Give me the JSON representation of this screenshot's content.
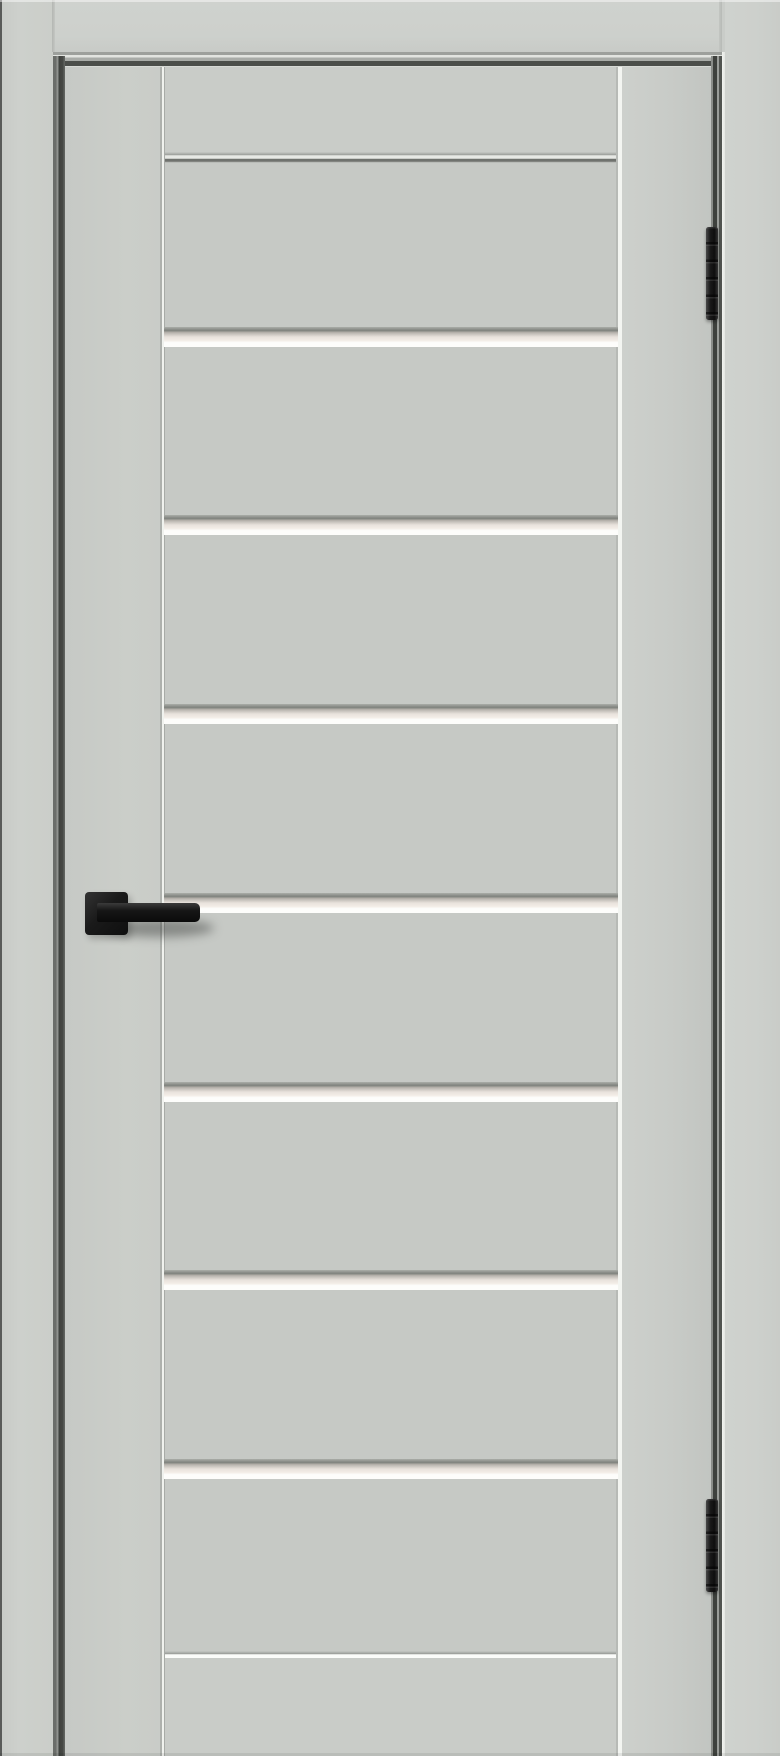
{
  "scene": {
    "type": "product-photo",
    "subject": "light grey interior door in a matching frame, with seven horizontal frosted-glass stripes across the centre panel, a matte black square-rose lever handle on the left stile and two dark concealed hinges in the right-hand gap"
  },
  "colors": {
    "frame": "#cdd0cc",
    "leaf": "#c9ccc8",
    "panel": "#c6c9c5",
    "glass": "#f3ede7",
    "glassbright": "#fdfdfb",
    "gapdark": "#3e413d",
    "hardware": "#1a1a1a"
  },
  "door": {
    "glass_stripes": {
      "count": 7,
      "top_positions_px": [
        327,
        515,
        704,
        893,
        1082,
        1270,
        1459
      ]
    },
    "hinges": {
      "count": 2,
      "top_positions_px": [
        227,
        1499
      ]
    },
    "handle": {
      "style": "square-rose straight lever",
      "finish": "matte black",
      "side": "left"
    }
  }
}
